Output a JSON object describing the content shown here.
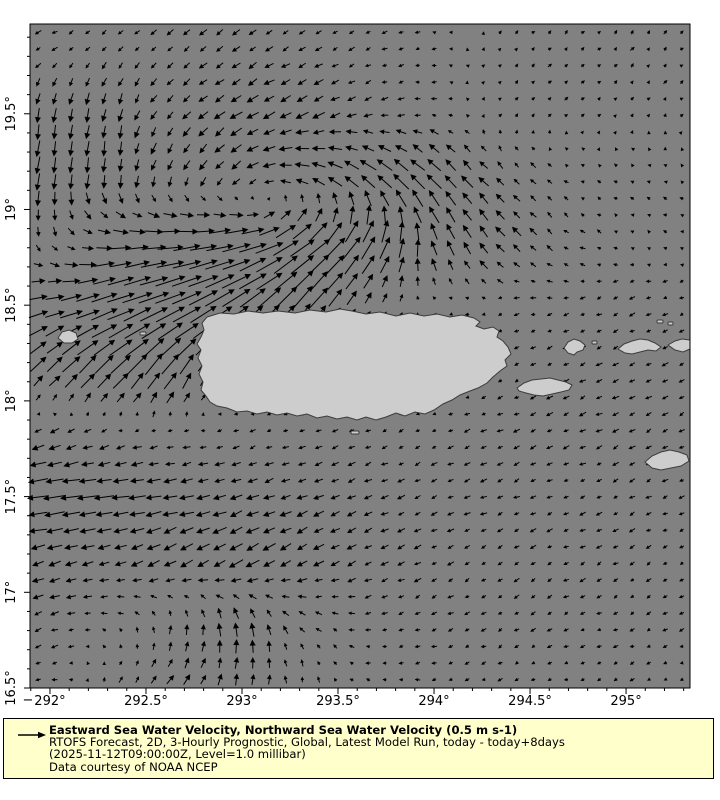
{
  "figure": {
    "bg": "#ffffff",
    "plot": {
      "left": 30,
      "top": 24,
      "right": 690,
      "bottom": 688,
      "ocean_color": "#818181",
      "land_color": "#cdcdcd",
      "land_stroke": "#3c3c3c",
      "arrow_color": "#000000",
      "frame_color": "#000000",
      "tick_label_color": "#000000",
      "corner_dash": "−"
    }
  },
  "legend": {
    "bg": "#ffffcc",
    "border": "#000000",
    "arrow_icon": "right-arrow",
    "title": "Eastward Sea Water Velocity, Northward Sea Water Velocity (0.5 m s-1)",
    "line2": "RTOFS Forecast, 2D, 3-Hourly Prognostic, Global, Latest Model Run, today - today+8days",
    "line3": "(2025-11-12T09:00:00Z, Level=1.0 millibar)",
    "line4": "Data courtesy of NOAA NCEP"
  },
  "chart_data": {
    "type": "quiver",
    "title": "Eastward Sea Water Velocity, Northward Sea Water Velocity (0.5 m s-1)",
    "subtitle": "RTOFS Forecast, 2D, 3-Hourly Prognostic, Global, Latest Model Run, today - today+8days (2025-11-12T09:00:00Z, Level=1.0 millibar)",
    "credit": "Data courtesy of NOAA NCEP",
    "lon_range": [
      291.896,
      295.333
    ],
    "lat_range": [
      16.5,
      19.969
    ],
    "x_ticks": {
      "values": [
        292,
        292.5,
        293,
        293.5,
        294,
        294.5,
        295
      ],
      "labels": [
        "292°",
        "292.5°",
        "293°",
        "293.5°",
        "294°",
        "294.5°",
        "295°"
      ]
    },
    "y_ticks": {
      "values": [
        16.5,
        17,
        17.5,
        18,
        18.5,
        19,
        19.5
      ],
      "labels": [
        "16.5°",
        "17°",
        "17.5°",
        "18°",
        "18.5°",
        "19°",
        "19.5°"
      ]
    },
    "minor_tick_step": 0.1,
    "grid": {
      "nx": 40,
      "ny": 40
    },
    "reference": {
      "value_ms": 0.5,
      "arrow_px": 24
    },
    "field": {
      "units": "m s-1",
      "lons": [
        292.0,
        292.33,
        292.67,
        293.0,
        293.33,
        293.67,
        294.0,
        294.33,
        294.67,
        295.0,
        295.33
      ],
      "lats": [
        16.5,
        16.83,
        17.17,
        17.5,
        17.83,
        18.17,
        18.5,
        18.83,
        19.17,
        19.5,
        19.83
      ],
      "u": [
        [
          -0.1,
          0.08,
          0.15,
          0.05,
          -0.02,
          -0.06,
          -0.08,
          -0.08,
          -0.07,
          -0.07,
          -0.06
        ],
        [
          -0.15,
          -0.08,
          0.02,
          -0.05,
          -0.1,
          -0.1,
          -0.1,
          -0.08,
          -0.08,
          -0.08,
          -0.08
        ],
        [
          -0.25,
          -0.22,
          -0.25,
          -0.28,
          -0.22,
          -0.15,
          -0.12,
          -0.1,
          -0.1,
          -0.1,
          -0.08
        ],
        [
          -0.45,
          -0.38,
          -0.3,
          -0.25,
          -0.2,
          -0.15,
          -0.12,
          -0.12,
          -0.1,
          -0.1,
          -0.1
        ],
        [
          -0.18,
          -0.12,
          -0.1,
          -0.1,
          -0.1,
          -0.1,
          -0.1,
          -0.12,
          -0.12,
          -0.12,
          -0.1
        ],
        [
          0.3,
          0.4,
          0.3,
          0.0,
          0.0,
          0.0,
          0.0,
          -0.05,
          -0.12,
          -0.12,
          -0.1
        ],
        [
          0.4,
          0.6,
          0.65,
          0.55,
          0.4,
          0.1,
          -0.05,
          -0.08,
          -0.1,
          -0.1,
          -0.08
        ],
        [
          0.05,
          0.35,
          0.55,
          0.6,
          0.5,
          0.3,
          -0.1,
          -0.2,
          -0.1,
          -0.06,
          -0.05
        ],
        [
          -0.05,
          -0.05,
          -0.1,
          -0.2,
          -0.3,
          -0.35,
          -0.3,
          -0.15,
          -0.08,
          -0.05,
          -0.05
        ],
        [
          -0.05,
          -0.05,
          -0.15,
          -0.25,
          -0.25,
          -0.15,
          -0.1,
          0.05,
          0.05,
          0.05,
          0.04
        ],
        [
          -0.1,
          -0.1,
          -0.12,
          -0.15,
          -0.12,
          -0.1,
          -0.08,
          0.05,
          0.06,
          0.06,
          0.05
        ]
      ],
      "v": [
        [
          -0.03,
          0.1,
          0.18,
          0.22,
          0.12,
          0.03,
          -0.02,
          -0.03,
          -0.03,
          -0.03,
          -0.03
        ],
        [
          -0.05,
          0.05,
          0.2,
          0.3,
          0.1,
          -0.02,
          -0.04,
          -0.05,
          -0.05,
          -0.04,
          -0.04
        ],
        [
          -0.08,
          -0.08,
          -0.15,
          -0.18,
          -0.12,
          -0.08,
          -0.06,
          -0.06,
          -0.05,
          -0.05,
          -0.04
        ],
        [
          -0.05,
          -0.05,
          -0.05,
          -0.08,
          -0.08,
          -0.06,
          -0.05,
          -0.05,
          -0.05,
          -0.05,
          -0.04
        ],
        [
          -0.1,
          -0.05,
          -0.03,
          -0.03,
          -0.04,
          -0.05,
          -0.05,
          -0.05,
          -0.06,
          -0.06,
          -0.05
        ],
        [
          0.3,
          0.4,
          0.45,
          0.0,
          0.0,
          0.0,
          0.0,
          -0.03,
          -0.05,
          -0.05,
          -0.05
        ],
        [
          0.1,
          0.2,
          0.28,
          0.4,
          0.5,
          0.15,
          0.02,
          -0.02,
          -0.03,
          -0.05,
          -0.05
        ],
        [
          -0.15,
          0.0,
          0.05,
          0.12,
          0.35,
          0.5,
          0.35,
          0.2,
          0.08,
          0.03,
          0.02
        ],
        [
          -0.35,
          -0.3,
          -0.2,
          -0.15,
          0.1,
          0.25,
          0.3,
          0.15,
          0.05,
          0.03,
          0.02
        ],
        [
          -0.3,
          -0.25,
          -0.15,
          -0.15,
          -0.12,
          -0.05,
          0.0,
          0.05,
          0.05,
          0.05,
          0.04
        ],
        [
          -0.05,
          -0.08,
          -0.1,
          -0.1,
          -0.08,
          -0.05,
          0.0,
          0.05,
          0.06,
          0.06,
          0.05
        ]
      ]
    },
    "islands": {
      "polygons": {
        "puerto-rico": [
          [
            207,
            317
          ],
          [
            220,
            313
          ],
          [
            234,
            314
          ],
          [
            248,
            311
          ],
          [
            263,
            313
          ],
          [
            278,
            311
          ],
          [
            295,
            313
          ],
          [
            310,
            310
          ],
          [
            326,
            312
          ],
          [
            340,
            309
          ],
          [
            352,
            311
          ],
          [
            366,
            314
          ],
          [
            380,
            312
          ],
          [
            396,
            316
          ],
          [
            410,
            313
          ],
          [
            424,
            316
          ],
          [
            437,
            314
          ],
          [
            450,
            317
          ],
          [
            462,
            315
          ],
          [
            474,
            318
          ],
          [
            480,
            322
          ],
          [
            476,
            326
          ],
          [
            484,
            329
          ],
          [
            493,
            327
          ],
          [
            499,
            331
          ],
          [
            497,
            337
          ],
          [
            503,
            341
          ],
          [
            508,
            347
          ],
          [
            511,
            354
          ],
          [
            505,
            360
          ],
          [
            507,
            366
          ],
          [
            500,
            371
          ],
          [
            493,
            377
          ],
          [
            487,
            383
          ],
          [
            478,
            388
          ],
          [
            470,
            391
          ],
          [
            460,
            395
          ],
          [
            452,
            400
          ],
          [
            443,
            404
          ],
          [
            434,
            410
          ],
          [
            425,
            414
          ],
          [
            415,
            412
          ],
          [
            405,
            416
          ],
          [
            396,
            413
          ],
          [
            386,
            417
          ],
          [
            376,
            420
          ],
          [
            366,
            417
          ],
          [
            357,
            420
          ],
          [
            347,
            417
          ],
          [
            337,
            419
          ],
          [
            327,
            416
          ],
          [
            317,
            418
          ],
          [
            307,
            414
          ],
          [
            297,
            416
          ],
          [
            287,
            413
          ],
          [
            277,
            415
          ],
          [
            267,
            412
          ],
          [
            257,
            414
          ],
          [
            247,
            411
          ],
          [
            237,
            412
          ],
          [
            227,
            408
          ],
          [
            217,
            406
          ],
          [
            210,
            402
          ],
          [
            206,
            396
          ],
          [
            201,
            390
          ],
          [
            203,
            382
          ],
          [
            199,
            374
          ],
          [
            202,
            366
          ],
          [
            198,
            358
          ],
          [
            201,
            350
          ],
          [
            197,
            344
          ],
          [
            201,
            337
          ],
          [
            204,
            330
          ],
          [
            202,
            323
          ]
        ],
        "vieques": [
          [
            517,
            388
          ],
          [
            524,
            383
          ],
          [
            532,
            380
          ],
          [
            541,
            379
          ],
          [
            550,
            378
          ],
          [
            558,
            380
          ],
          [
            566,
            382
          ],
          [
            572,
            385
          ],
          [
            569,
            390
          ],
          [
            561,
            392
          ],
          [
            552,
            394
          ],
          [
            543,
            396
          ],
          [
            534,
            395
          ],
          [
            526,
            393
          ],
          [
            519,
            391
          ]
        ],
        "culebra": [
          [
            564,
            348
          ],
          [
            568,
            342
          ],
          [
            574,
            339
          ],
          [
            580,
            341
          ],
          [
            585,
            345
          ],
          [
            583,
            350
          ],
          [
            577,
            352
          ],
          [
            574,
            355
          ],
          [
            568,
            353
          ]
        ],
        "st-thomas": [
          [
            618,
            349
          ],
          [
            624,
            344
          ],
          [
            632,
            341
          ],
          [
            640,
            339
          ],
          [
            648,
            340
          ],
          [
            655,
            343
          ],
          [
            661,
            347
          ],
          [
            656,
            351
          ],
          [
            648,
            350
          ],
          [
            640,
            352
          ],
          [
            632,
            354
          ],
          [
            625,
            353
          ]
        ],
        "tortola": [
          [
            668,
            345
          ],
          [
            675,
            341
          ],
          [
            682,
            339
          ],
          [
            690,
            340
          ],
          [
            690,
            349
          ],
          [
            683,
            352
          ],
          [
            675,
            350
          ]
        ],
        "st-croix": [
          [
            645,
            462
          ],
          [
            652,
            456
          ],
          [
            661,
            452
          ],
          [
            670,
            450
          ],
          [
            679,
            452
          ],
          [
            687,
            455
          ],
          [
            689,
            461
          ],
          [
            681,
            466
          ],
          [
            671,
            468
          ],
          [
            661,
            470
          ],
          [
            652,
            468
          ]
        ],
        "mona": [
          [
            58,
            338
          ],
          [
            62,
            332
          ],
          [
            69,
            330
          ],
          [
            76,
            333
          ],
          [
            78,
            339
          ],
          [
            72,
            343
          ],
          [
            64,
            343
          ]
        ]
      },
      "specks": [
        [
          140,
          332,
          6,
          3
        ],
        [
          351,
          431,
          8,
          3
        ],
        [
          592,
          341,
          5,
          3
        ],
        [
          657,
          320,
          6,
          3
        ],
        [
          668,
          322,
          5,
          3
        ]
      ]
    }
  }
}
